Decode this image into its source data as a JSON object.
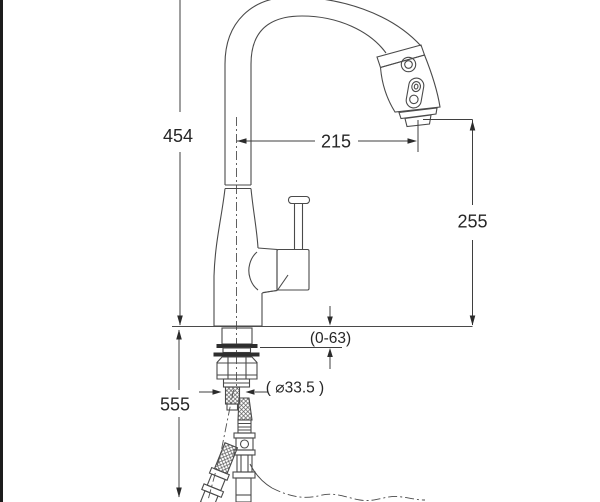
{
  "drawing": {
    "title": "pull-down-kitchen-faucet-installation-drawing",
    "background_color": "#ffffff",
    "line_color": "#4a4a4a",
    "dimension_line_color": "#3f3f3f",
    "text_color": "#262626",
    "border_color": "#1c1c1c",
    "dimensions": {
      "spout_height": "454",
      "spout_reach": "215",
      "outlet_clearance": "255",
      "supply_hose_length": "555",
      "deck_thickness_range": "(0-63)",
      "mount_hole_diameter": "( ⌀33.5 )"
    }
  }
}
